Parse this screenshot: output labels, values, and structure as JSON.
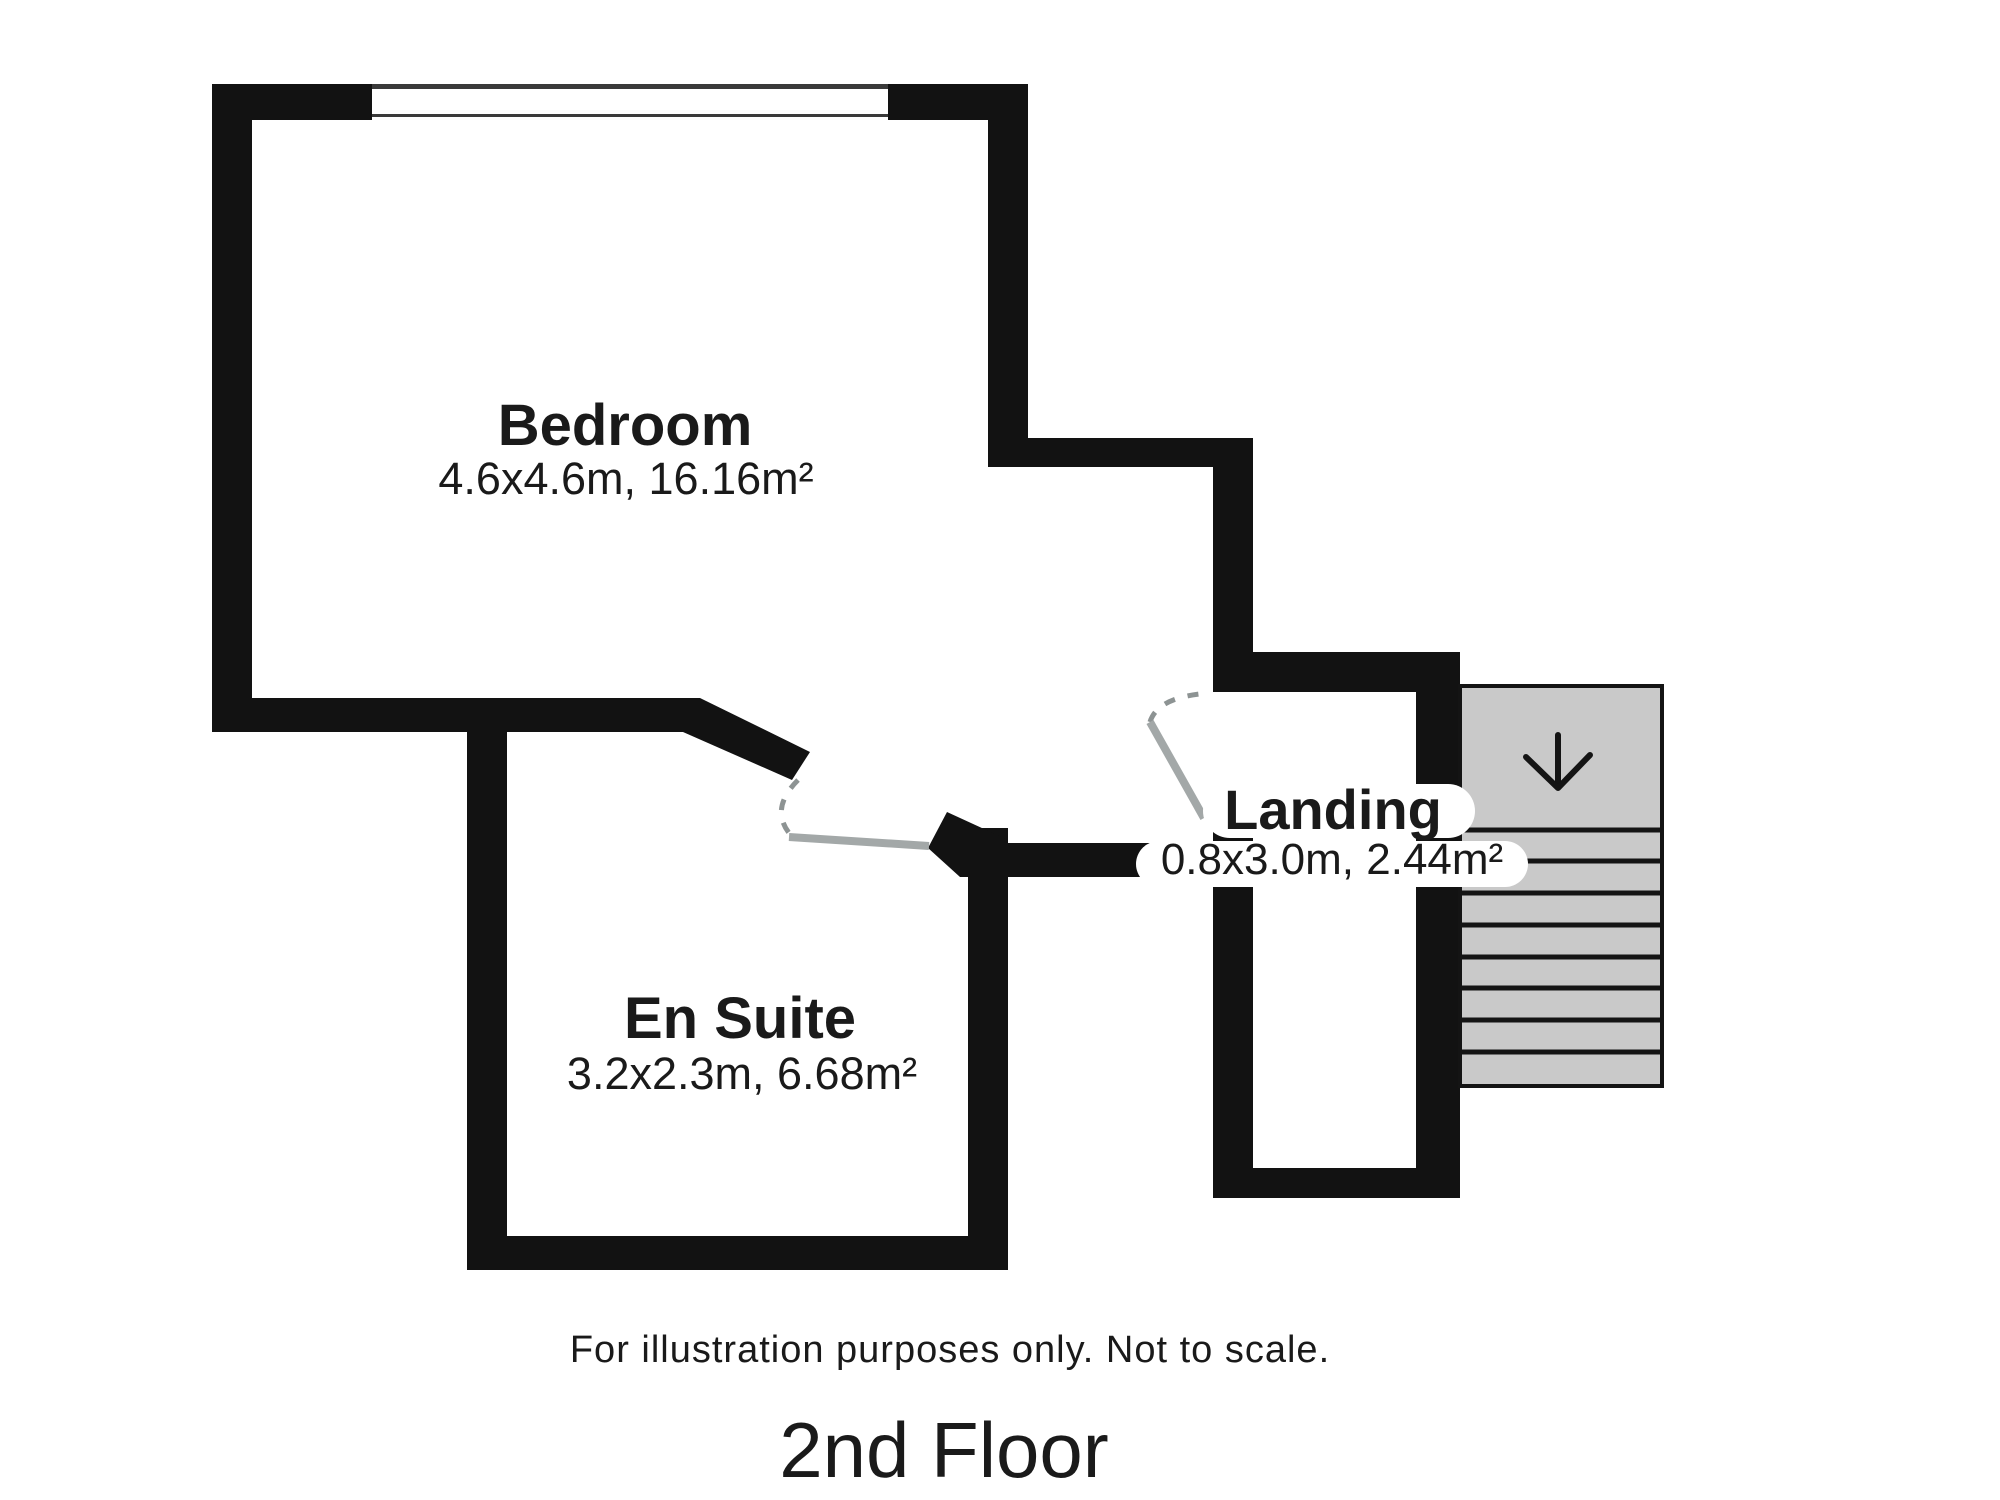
{
  "title": "2nd Floor",
  "disclaimer": "For illustration purposes only. Not to scale.",
  "rooms": {
    "bedroom": {
      "name": "Bedroom",
      "dimensions": "4.6x4.6m, 16.16m²"
    },
    "en_suite": {
      "name": "En Suite",
      "dimensions": "3.2x2.3m, 6.68m²"
    },
    "landing": {
      "name": "Landing",
      "dimensions": "0.8x3.0m, 2.44m²"
    }
  },
  "stairs": {
    "direction_icon": "down-arrow",
    "tread_count": 8
  },
  "colors": {
    "wall": "#121212",
    "outline": "#141414",
    "stairs_fill": "#c9c9c9",
    "door_leaf": "#a3a8a8",
    "door_swing": "#8d9393",
    "window_frame": "#3a3a3a",
    "text": "#1a1a1a",
    "background": "#ffffff"
  }
}
